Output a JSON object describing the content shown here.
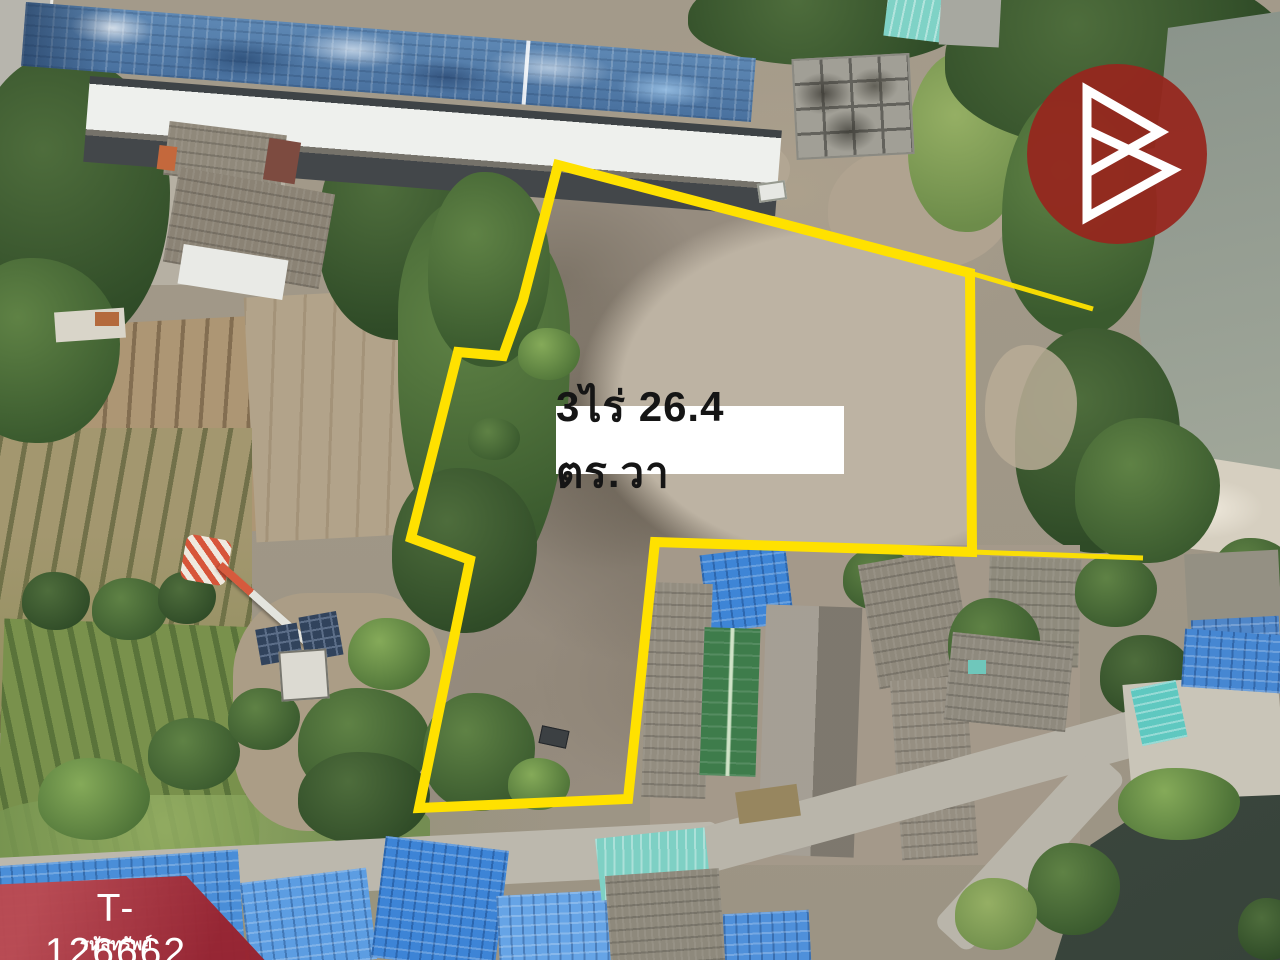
{
  "overlay": {
    "area_label": "3ไร่ 26.4 ตร.วา"
  },
  "banner": {
    "code": "T-126662",
    "caption": "รหัสทรัพย์"
  },
  "colors": {
    "boundary_yellow": "#ffe100",
    "banner_red": "#9d2833",
    "logo_red": "#96261e",
    "label_bg": "#ffffff",
    "label_text": "#151515"
  },
  "icons": [
    {
      "name": "brand-logo-b-triangles",
      "meaning": "brand watermark: two overlapping right-pointing triangle outlines forming a B"
    }
  ]
}
